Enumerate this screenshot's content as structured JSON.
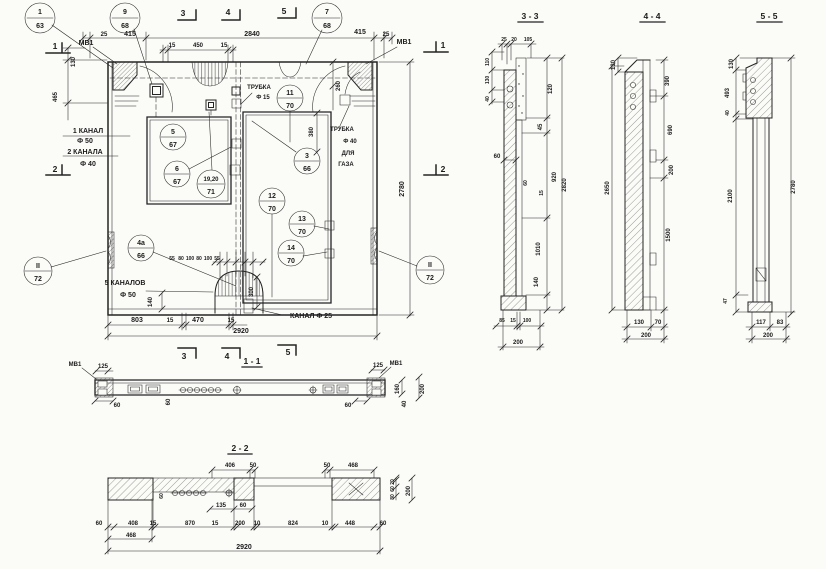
{
  "main": {
    "markers": {
      "m1": "1",
      "m2": "2",
      "m3": "3",
      "m4": "4",
      "m5": "5"
    },
    "embeds": {
      "left": "МВ1",
      "right": "МВ1"
    },
    "callouts": [
      {
        "n": "1",
        "p": "63"
      },
      {
        "n": "9",
        "p": "68"
      },
      {
        "n": "7",
        "p": "68"
      },
      {
        "n": "5",
        "p": "67"
      },
      {
        "n": "6",
        "p": "67"
      },
      {
        "n": "19,20",
        "p": "71"
      },
      {
        "n": "11",
        "p": "70"
      },
      {
        "n": "3",
        "p": "66"
      },
      {
        "n": "12",
        "p": "70"
      },
      {
        "n": "13",
        "p": "70"
      },
      {
        "n": "14",
        "p": "70"
      },
      {
        "n": "4а",
        "p": "66"
      },
      {
        "n": "II",
        "p": "72"
      },
      {
        "n": "II",
        "p": "72"
      }
    ],
    "notes": {
      "ch1": "1 КАНАЛ",
      "ch1d": "Ф 50",
      "ch2": "2 КАНАЛА",
      "ch2d": "Ф 40",
      "t15a": "ТРУБКА",
      "t15b": "Ф 15",
      "t40a": "ТРУБКА",
      "t40b": "Ф 40",
      "t40c": "ДЛЯ",
      "t40d": "ГАЗА",
      "ch5a": "5 КАНАЛОВ",
      "ch5b": "Ф 50",
      "ch25": "КАНАЛ Ф 25"
    },
    "dims": {
      "top": [
        "25",
        "415",
        "15",
        "450",
        "15",
        "2840",
        "415",
        "25"
      ],
      "left": [
        "130",
        "465"
      ],
      "right": [
        "260",
        "2780"
      ],
      "inner": [
        "380",
        "300",
        "140"
      ],
      "ch": [
        "55",
        "80",
        "100",
        "80",
        "100",
        "55"
      ],
      "bottom": [
        "803",
        "15",
        "470",
        "15",
        "2920"
      ]
    }
  },
  "s11": {
    "title": "1 - 1",
    "embed_left": "МВ1",
    "embed_right": "МВ1",
    "dims": {
      "d125l": "125",
      "d125r": "125",
      "d60l": "60",
      "d60m": "60",
      "d60r": "60",
      "d160": "160",
      "d200": "200",
      "d40": "40"
    }
  },
  "s22": {
    "title": "2 - 2",
    "dims": {
      "top": [
        "406",
        "50",
        "50",
        "468"
      ],
      "mid": [
        "60",
        "135",
        "60"
      ],
      "bottom": [
        "60",
        "408",
        "15",
        "870",
        "15",
        "200",
        "10",
        "824",
        "10",
        "448",
        "60"
      ],
      "sub": "468",
      "total": "2920",
      "right": [
        "20",
        "60",
        "80",
        "200"
      ]
    }
  },
  "s33": {
    "title": "3 - 3",
    "dims": {
      "top": [
        "25",
        "20",
        "105"
      ],
      "left": [
        "110",
        "130",
        "40"
      ],
      "l60": "60",
      "inner": [
        "60",
        "15"
      ],
      "right": [
        "120",
        "45",
        "920",
        "1010",
        "140",
        "2820"
      ],
      "bottom": [
        "85",
        "15",
        "100",
        "200"
      ]
    }
  },
  "s44": {
    "title": "4 - 4",
    "dims": {
      "left": [
        "130",
        "2650"
      ],
      "right": [
        "390",
        "690",
        "200",
        "1500"
      ],
      "bottom": [
        "130",
        "70",
        "200"
      ]
    }
  },
  "s55": {
    "title": "5 - 5",
    "dims": {
      "left": [
        "130",
        "493",
        "40",
        "2100",
        "47"
      ],
      "right": "2780",
      "bottom": [
        "117",
        "83",
        "200"
      ]
    }
  }
}
